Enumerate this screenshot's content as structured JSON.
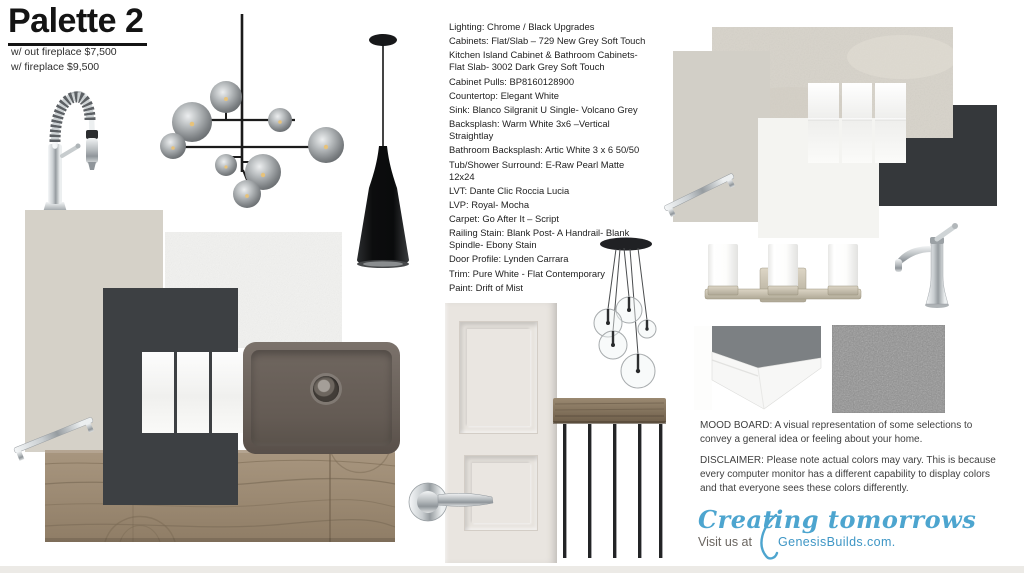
{
  "header": {
    "title": "Palette 2",
    "price_without_fireplace": "w/ out fireplace $7,500",
    "price_with_fireplace": "w/ fireplace $9,500"
  },
  "specs": {
    "items": [
      [
        "Lighting: Chrome / Black Upgrades"
      ],
      [
        "Cabinets: Flat/Slab – 729 New Grey Soft Touch"
      ],
      [
        "Kitchen Island Cabinet & Bathroom Cabinets-",
        "Flat Slab- 3002 Dark Grey Soft Touch"
      ],
      [
        "Cabinet Pulls: BP8160128900"
      ],
      [
        "Countertop: Elegant White"
      ],
      [
        "Sink: Blanco Silgranit U Single- Volcano Grey"
      ],
      [
        "Backsplash: Warm White 3x6 –Vertical",
        "Straightlay"
      ],
      [
        "Bathroom Backsplash: Artic White 3 x 6 50/50"
      ],
      [
        "Tub/Shower Surround: E-Raw Pearl Matte",
        "12x24"
      ],
      [
        "LVT: Dante Clic Roccia Lucia"
      ],
      [
        "LVP: Royal- Mocha"
      ],
      [
        "Carpet: Go After It – Script"
      ],
      [
        "Railing Stain: Blank Post- A Handrail- Blank",
        "Spindle- Ebony Stain"
      ],
      [
        "Door Profile: Lynden Carrara"
      ],
      [
        "Trim: Pure White - Flat Contemporary"
      ],
      [
        "Paint: Drift of Mist"
      ]
    ]
  },
  "notes": {
    "mood_board_lines": [
      "MOOD BOARD:  A visual representation of some selections to",
      "convey a general idea or feeling about your home."
    ],
    "disclaimer_lines": [
      "DISCLAIMER:  Please note actual colors may vary. This is because",
      "every computer monitor has a different capability to display colors",
      "and that everyone sees these colors differently."
    ]
  },
  "footer": {
    "tagline": "Creating tomorrows",
    "visit_prefix": "Visit us at",
    "site": "GenesisBuilds.com."
  },
  "colors": {
    "paint_drift_of_mist": "#d5d1c8",
    "cabinet_dark_grey": "#3d4043",
    "tile_dark": "#35383b",
    "tile_beige": "#d7d3ca",
    "square_grey": "#d2cfc7",
    "square_white": "#f4f4f1",
    "countertop_white": "#f2f2f0",
    "carpet_grey": "#8f8f8f",
    "sink_volcano_grey": "#6a615a",
    "wood_lvp_mocha": "#9c8a73",
    "accent_blue": "#4da5cf",
    "text_dark": "#222222"
  }
}
